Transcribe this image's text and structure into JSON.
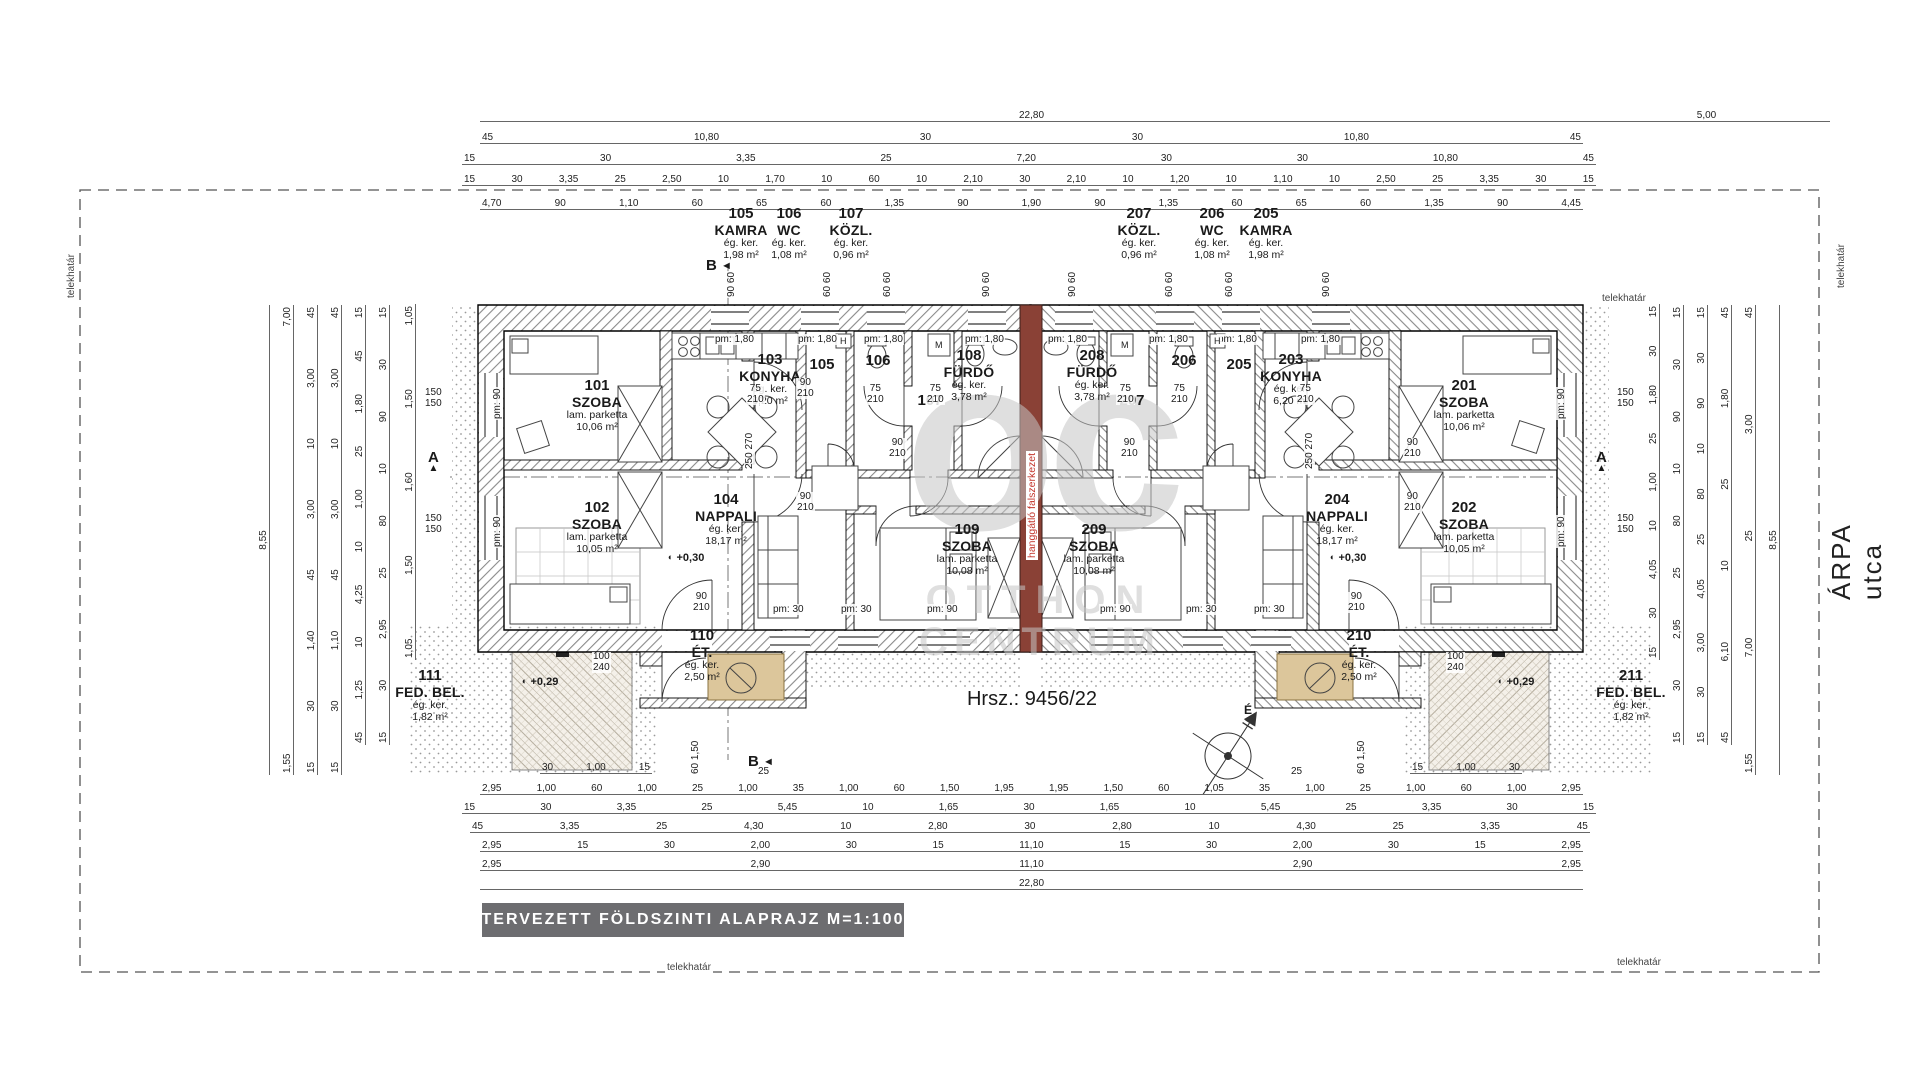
{
  "title_bar": "TERVEZETT  FÖLDSZINTI  ALAPRAJZ  M=1:100",
  "parcel": "Hrsz.: 9456/22",
  "street": "ÁRPA utca",
  "boundary_label": "telekhatár",
  "party_wall_label": "hanggátló falszerkezet",
  "north_letter": "É",
  "watermark": {
    "logo": "oc",
    "line1": "OTTHON",
    "line2": "CENTRUM"
  },
  "sections": {
    "a": "A",
    "b": "B",
    "arrow": "◄",
    "tri": "▲"
  },
  "levels": {
    "nappali": "+0,30",
    "terrace": "+0,29",
    "sym": "◐"
  },
  "rooms": [
    {
      "num": "101",
      "name": "SZOBA",
      "finish": "lam. parketta",
      "area": "10,06 m²"
    },
    {
      "num": "102",
      "name": "SZOBA",
      "finish": "lam. parketta",
      "area": "10,05 m²"
    },
    {
      "num": "103",
      "name": "KONYHA",
      "finish": "ég. ker.",
      "area": "6,20 m²"
    },
    {
      "num": "104",
      "name": "NAPPALI",
      "finish": "ég. ker.",
      "area": "18,17 m²"
    },
    {
      "num": "105",
      "name": "KAMRA",
      "finish": "ég. ker.",
      "area": "1,98 m²"
    },
    {
      "num": "106",
      "name": "WC",
      "finish": "ég. ker.",
      "area": "1,08 m²"
    },
    {
      "num": "107",
      "name": "KÖZL.",
      "finish": "ég. ker.",
      "area": "0,96 m²"
    },
    {
      "num": "108",
      "name": "FÜRDŐ",
      "finish": "ég. ker.",
      "area": "3,78 m²"
    },
    {
      "num": "109",
      "name": "SZOBA",
      "finish": "lam. parketta",
      "area": "10,08 m²"
    },
    {
      "num": "110",
      "name": "ÉT.",
      "finish": "ég. ker.",
      "area": "2,50 m²"
    },
    {
      "num": "111",
      "name": "FED. BEL.",
      "finish": "ég. ker.",
      "area": "1,82 m²"
    },
    {
      "num": "201",
      "name": "SZOBA",
      "finish": "lam. parketta",
      "area": "10,06 m²"
    },
    {
      "num": "202",
      "name": "SZOBA",
      "finish": "lam. parketta",
      "area": "10,05 m²"
    },
    {
      "num": "203",
      "name": "KONYHA",
      "finish": "ég. ker.",
      "area": "6,20 m²"
    },
    {
      "num": "204",
      "name": "NAPPALI",
      "finish": "ég. ker.",
      "area": "18,17 m²"
    },
    {
      "num": "205",
      "name": "KAMRA",
      "finish": "ég. ker.",
      "area": "1,98 m²"
    },
    {
      "num": "206",
      "name": "WC",
      "finish": "ég. ker.",
      "area": "1,08 m²"
    },
    {
      "num": "207",
      "name": "KÖZL.",
      "finish": "ég. ker.",
      "area": "0,96 m²"
    },
    {
      "num": "208",
      "name": "FÜRDŐ",
      "finish": "ég. ker.",
      "area": "3,78 m²"
    },
    {
      "num": "209",
      "name": "SZOBA",
      "finish": "lam. parketta",
      "area": "10,08 m²"
    },
    {
      "num": "210",
      "name": "ÉT.",
      "finish": "ég. ker.",
      "area": "2,50 m²"
    },
    {
      "num": "211",
      "name": "FED. BEL.",
      "finish": "ég. ker.",
      "area": "1,82 m²"
    }
  ],
  "tags": {
    "pm180": "pm:  1,80",
    "pm90": "pm:  90",
    "pm30": "pm:  30",
    "w90": "90",
    "w210": "210",
    "w75": "75",
    "w100": "100",
    "w240": "240",
    "w150": "150",
    "p9060": "90  60",
    "p6060": "60  60",
    "p250270": "250  270",
    "p60150": "60  1,50",
    "p25": "25",
    "m": "M",
    "h": "H"
  },
  "dims": {
    "top": [
      {
        "values": [
          "22,80"
        ]
      },
      {
        "values": [
          "5,00"
        ]
      },
      {
        "values": [
          "45",
          "10,80",
          "30",
          "30",
          "10,80",
          "45"
        ]
      },
      {
        "values": [
          "15",
          "30",
          "3,35",
          "25",
          "7,20",
          "30",
          "30",
          "10,80",
          "45"
        ]
      },
      {
        "values": [
          "15",
          "30",
          "3,35",
          "25",
          "2,50",
          "10",
          "1,70",
          "10",
          "60",
          "10",
          "2,10",
          "30",
          "2,10",
          "10",
          "1,20",
          "10",
          "1,10",
          "10",
          "2,50",
          "25",
          "3,35",
          "30",
          "15"
        ]
      },
      {
        "values": [
          "4,70",
          "90",
          "1,10",
          "60",
          "65",
          "60",
          "1,35",
          "90",
          "1,90",
          "90",
          "1,35",
          "60",
          "65",
          "60",
          "1,35",
          "90",
          "4,45"
        ]
      }
    ],
    "bottom": [
      {
        "values": [
          "30",
          "1,00",
          "15"
        ]
      },
      {
        "values": [
          "15",
          "1,00",
          "30"
        ]
      },
      {
        "values": [
          "2,95",
          "1,00",
          "60",
          "1,00",
          "25",
          "1,00",
          "35",
          "1,00",
          "60",
          "1,50",
          "1,95",
          "1,95",
          "1,50",
          "60",
          "1,05",
          "35",
          "1,00",
          "25",
          "1,00",
          "60",
          "1,00",
          "2,95"
        ]
      },
      {
        "values": [
          "15",
          "30",
          "3,35",
          "25",
          "5,45",
          "10",
          "1,65",
          "30",
          "1,65",
          "10",
          "5,45",
          "25",
          "3,35",
          "30",
          "15"
        ]
      },
      {
        "values": [
          "45",
          "3,35",
          "25",
          "4,30",
          "10",
          "2,80",
          "30",
          "2,80",
          "10",
          "4,30",
          "25",
          "3,35",
          "45"
        ]
      },
      {
        "values": [
          "2,95",
          "15",
          "30",
          "2,00",
          "30",
          "15",
          "11,10",
          "15",
          "30",
          "2,00",
          "30",
          "15",
          "2,95"
        ]
      },
      {
        "values": [
          "2,95",
          "2,90",
          "11,10",
          "2,90",
          "2,95"
        ]
      },
      {
        "values": [
          "22,80"
        ]
      }
    ],
    "left": [
      [
        "8,55"
      ],
      [
        "7,00",
        "1,55"
      ],
      [
        "45",
        "3,00",
        "10",
        "3,00",
        "45",
        "1,40",
        "30",
        "15"
      ],
      [
        "45",
        "3,00",
        "10",
        "3,00",
        "45",
        "1,10",
        "30",
        "15"
      ],
      [
        "15",
        "45",
        "1,80",
        "25",
        "1,00",
        "10",
        "4,25",
        "10",
        "1,25",
        "45"
      ],
      [
        "15",
        "30",
        "90",
        "10",
        "80",
        "25",
        "2,95",
        "30",
        "15"
      ],
      [
        "1,05",
        "1,50",
        "1,60",
        "1,50",
        "1,05"
      ]
    ],
    "right": [
      [
        "15",
        "30",
        "1,80",
        "25",
        "1,00",
        "10",
        "4,05",
        "30",
        "15"
      ],
      [
        "15",
        "30",
        "90",
        "10",
        "80",
        "25",
        "2,95",
        "30",
        "15"
      ],
      [
        "15",
        "30",
        "90",
        "10",
        "80",
        "25",
        "4,05",
        "3,00",
        "30",
        "15"
      ],
      [
        "45",
        "1,80",
        "25",
        "10",
        "6,10",
        "45"
      ],
      [
        "45",
        "3,00",
        "25",
        "7,00",
        "1,55"
      ],
      [
        "8,55"
      ]
    ]
  }
}
